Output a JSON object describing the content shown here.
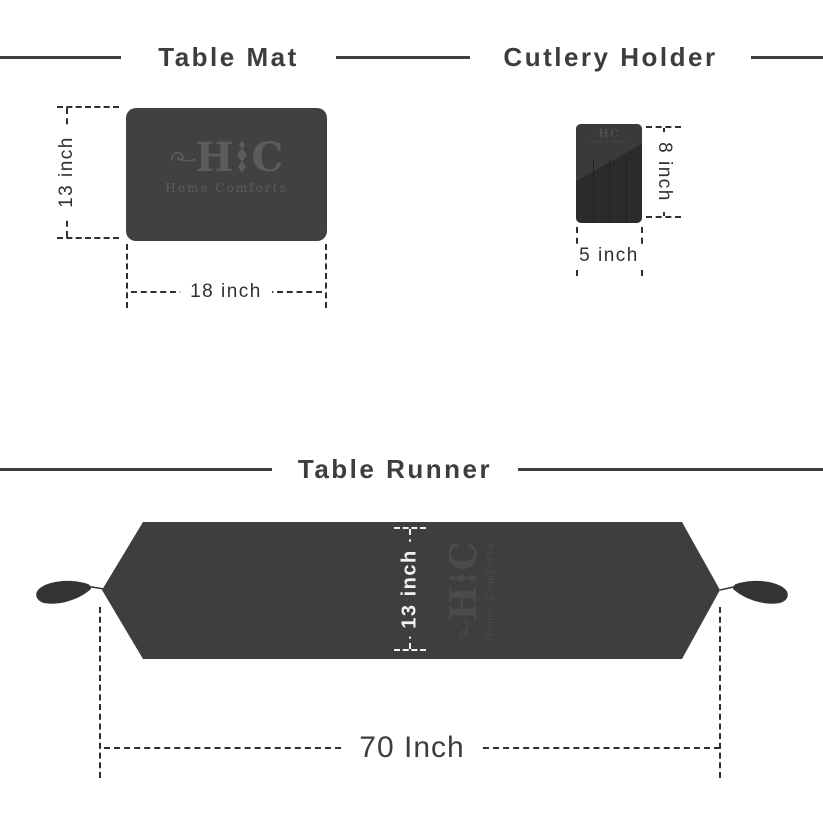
{
  "brand": {
    "monogram_left": "H",
    "monogram_right": "C",
    "name": "Home Comforts"
  },
  "table_mat": {
    "title": "Table Mat",
    "height_label": "13 inch",
    "width_label": "18 inch"
  },
  "cutlery_holder": {
    "title": "Cutlery Holder",
    "height_label": "8 inch",
    "width_label": "5 inch"
  },
  "table_runner": {
    "title": "Table Runner",
    "height_label": "13 inch",
    "width_label": "70 Inch"
  },
  "colors": {
    "background": "#ffffff",
    "ink": "#3b3d3f",
    "dim_line": "#2f2f2f",
    "mat_fill": "#414141",
    "holder_fill": "#2b2b2b",
    "holder_sheen": "#3a3a3a",
    "runner_fill": "#3e3e3e",
    "logo_gray": "#5c5c5c",
    "runner_logo_gray": "#4b4b4b",
    "white_dim": "#f2f2f2",
    "tassel": "#333333"
  }
}
